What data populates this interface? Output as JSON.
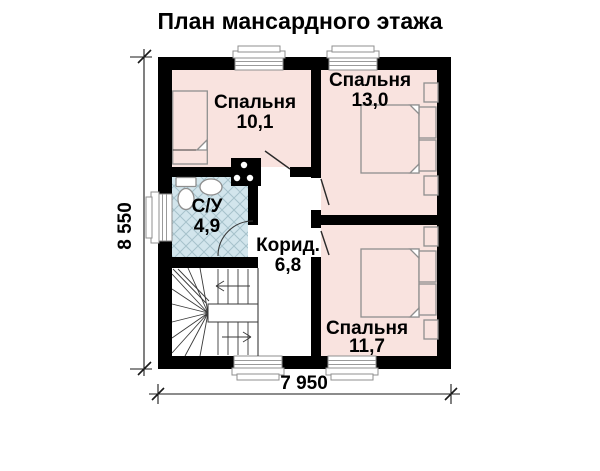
{
  "title": "План мансардного этажа",
  "rooms": {
    "bedroom_top_left": {
      "name": "Спальня",
      "area": "10,1"
    },
    "bedroom_top_right": {
      "name": "Спальня",
      "area": "13,0"
    },
    "bathroom": {
      "name": "С/У",
      "area": "4,9"
    },
    "corridor": {
      "name": "Корид.",
      "area": "6,8"
    },
    "bedroom_bottom_right": {
      "name": "Спальня",
      "area": "11,7"
    }
  },
  "dimensions": {
    "overall_width": "7 950",
    "overall_height": "8 550"
  },
  "colors": {
    "wall": "#000000",
    "room_fill": "#f9e3df",
    "bathroom_fill": "#d2e5ec",
    "tile_line": "#a6c2cb",
    "furniture_stroke": "#8f8f8f",
    "background": "#ffffff"
  }
}
